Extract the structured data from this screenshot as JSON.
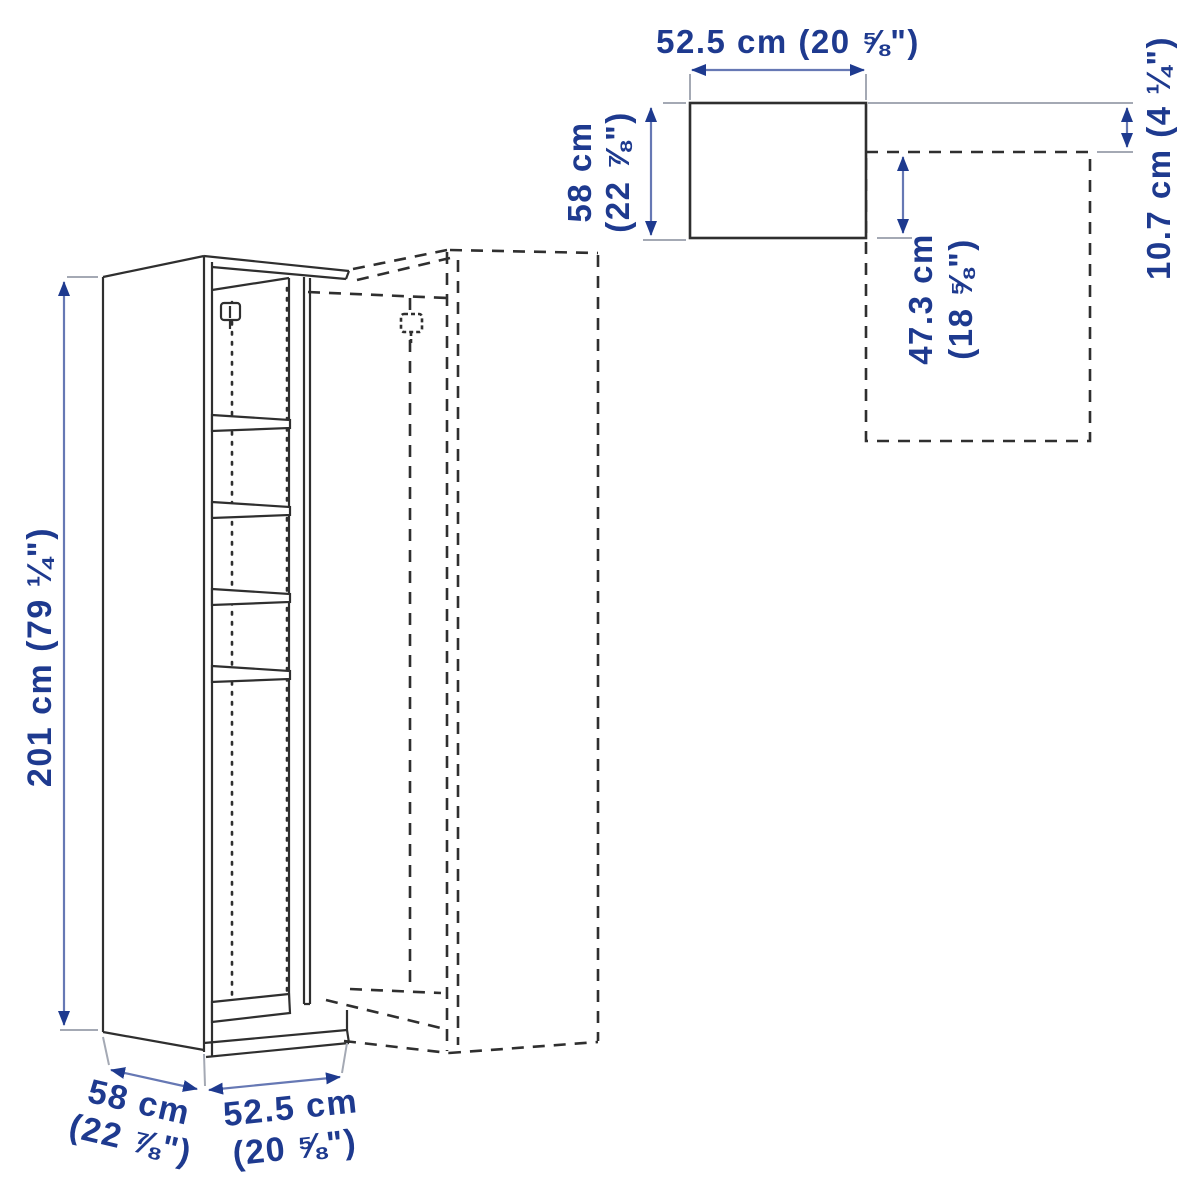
{
  "page": {
    "title": "Wardrobe frame with add-on corner unit — dimension diagram",
    "background": "#ffffff"
  },
  "colors": {
    "dimension_text": "#1e3a8f",
    "arrow_head": "#1e3a8f",
    "arrow_shaft": "#6678b4",
    "leader_line": "#a4a9b4",
    "artwork_line": "#2f2f2f"
  },
  "side_view": {
    "height_label": "201 cm (79 ¼\")",
    "depth_label_line1": "58 cm",
    "depth_label_line2": "(22 ⅞\")",
    "width_label_line1": "52.5 cm",
    "width_label_line2": "(20 ⅝\")"
  },
  "plan_view": {
    "width_label": "52.5 cm (20 ⅝\")",
    "depth_label_line1": "58 cm",
    "depth_label_line2": "(22 ⅞\")",
    "overlap_label_line1": "47.3 cm",
    "overlap_label_line2": "(18 ⅝\")",
    "offset_label": "10.7 cm (4 ¼\")"
  }
}
